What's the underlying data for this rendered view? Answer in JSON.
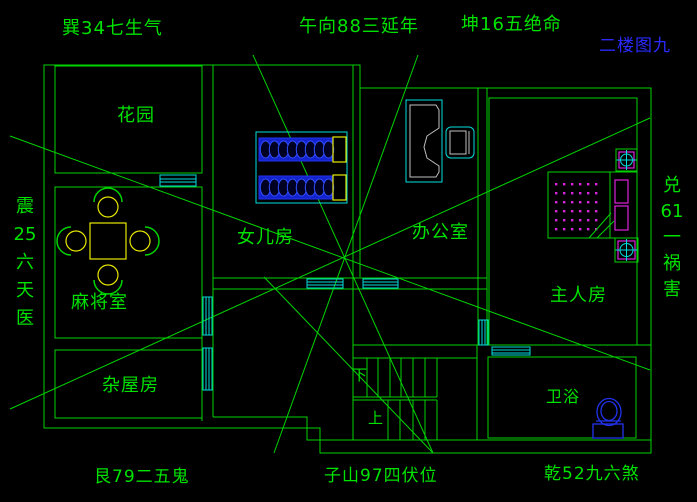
{
  "colors": {
    "background": "#000000",
    "line_green": "#00d400",
    "text_green": "#00e200",
    "window_cyan": "#00dede",
    "furniture_blue": "#2233ee",
    "bed_fill": "#1322cc",
    "coil_blue": "#3050ff",
    "accent_yellow": "#e8e800",
    "dot_magenta": "#dd22dd",
    "desk_gray": "#c0c0c0",
    "label_blue": "#2a2aff"
  },
  "compass": {
    "top_left": "巽34七生气",
    "top_center": "午向88三延年",
    "top_right": "坤16五绝命",
    "bottom_left": "艮79二五鬼",
    "bottom_center": "子山97四伏位",
    "bottom_right": "乾52九六煞",
    "left_column": [
      "震",
      "25",
      "六",
      "天",
      "医"
    ],
    "right_column": [
      "兑",
      "61",
      "一",
      "祸",
      "害"
    ]
  },
  "floor_label": "二楼图九",
  "rooms": {
    "garden": "花园",
    "daughter": "女儿房",
    "office": "办公室",
    "mahjong": "麻将室",
    "master": "主人房",
    "storage": "杂屋房",
    "bath": "卫浴"
  },
  "stairs": {
    "down": "下",
    "up": "上"
  }
}
